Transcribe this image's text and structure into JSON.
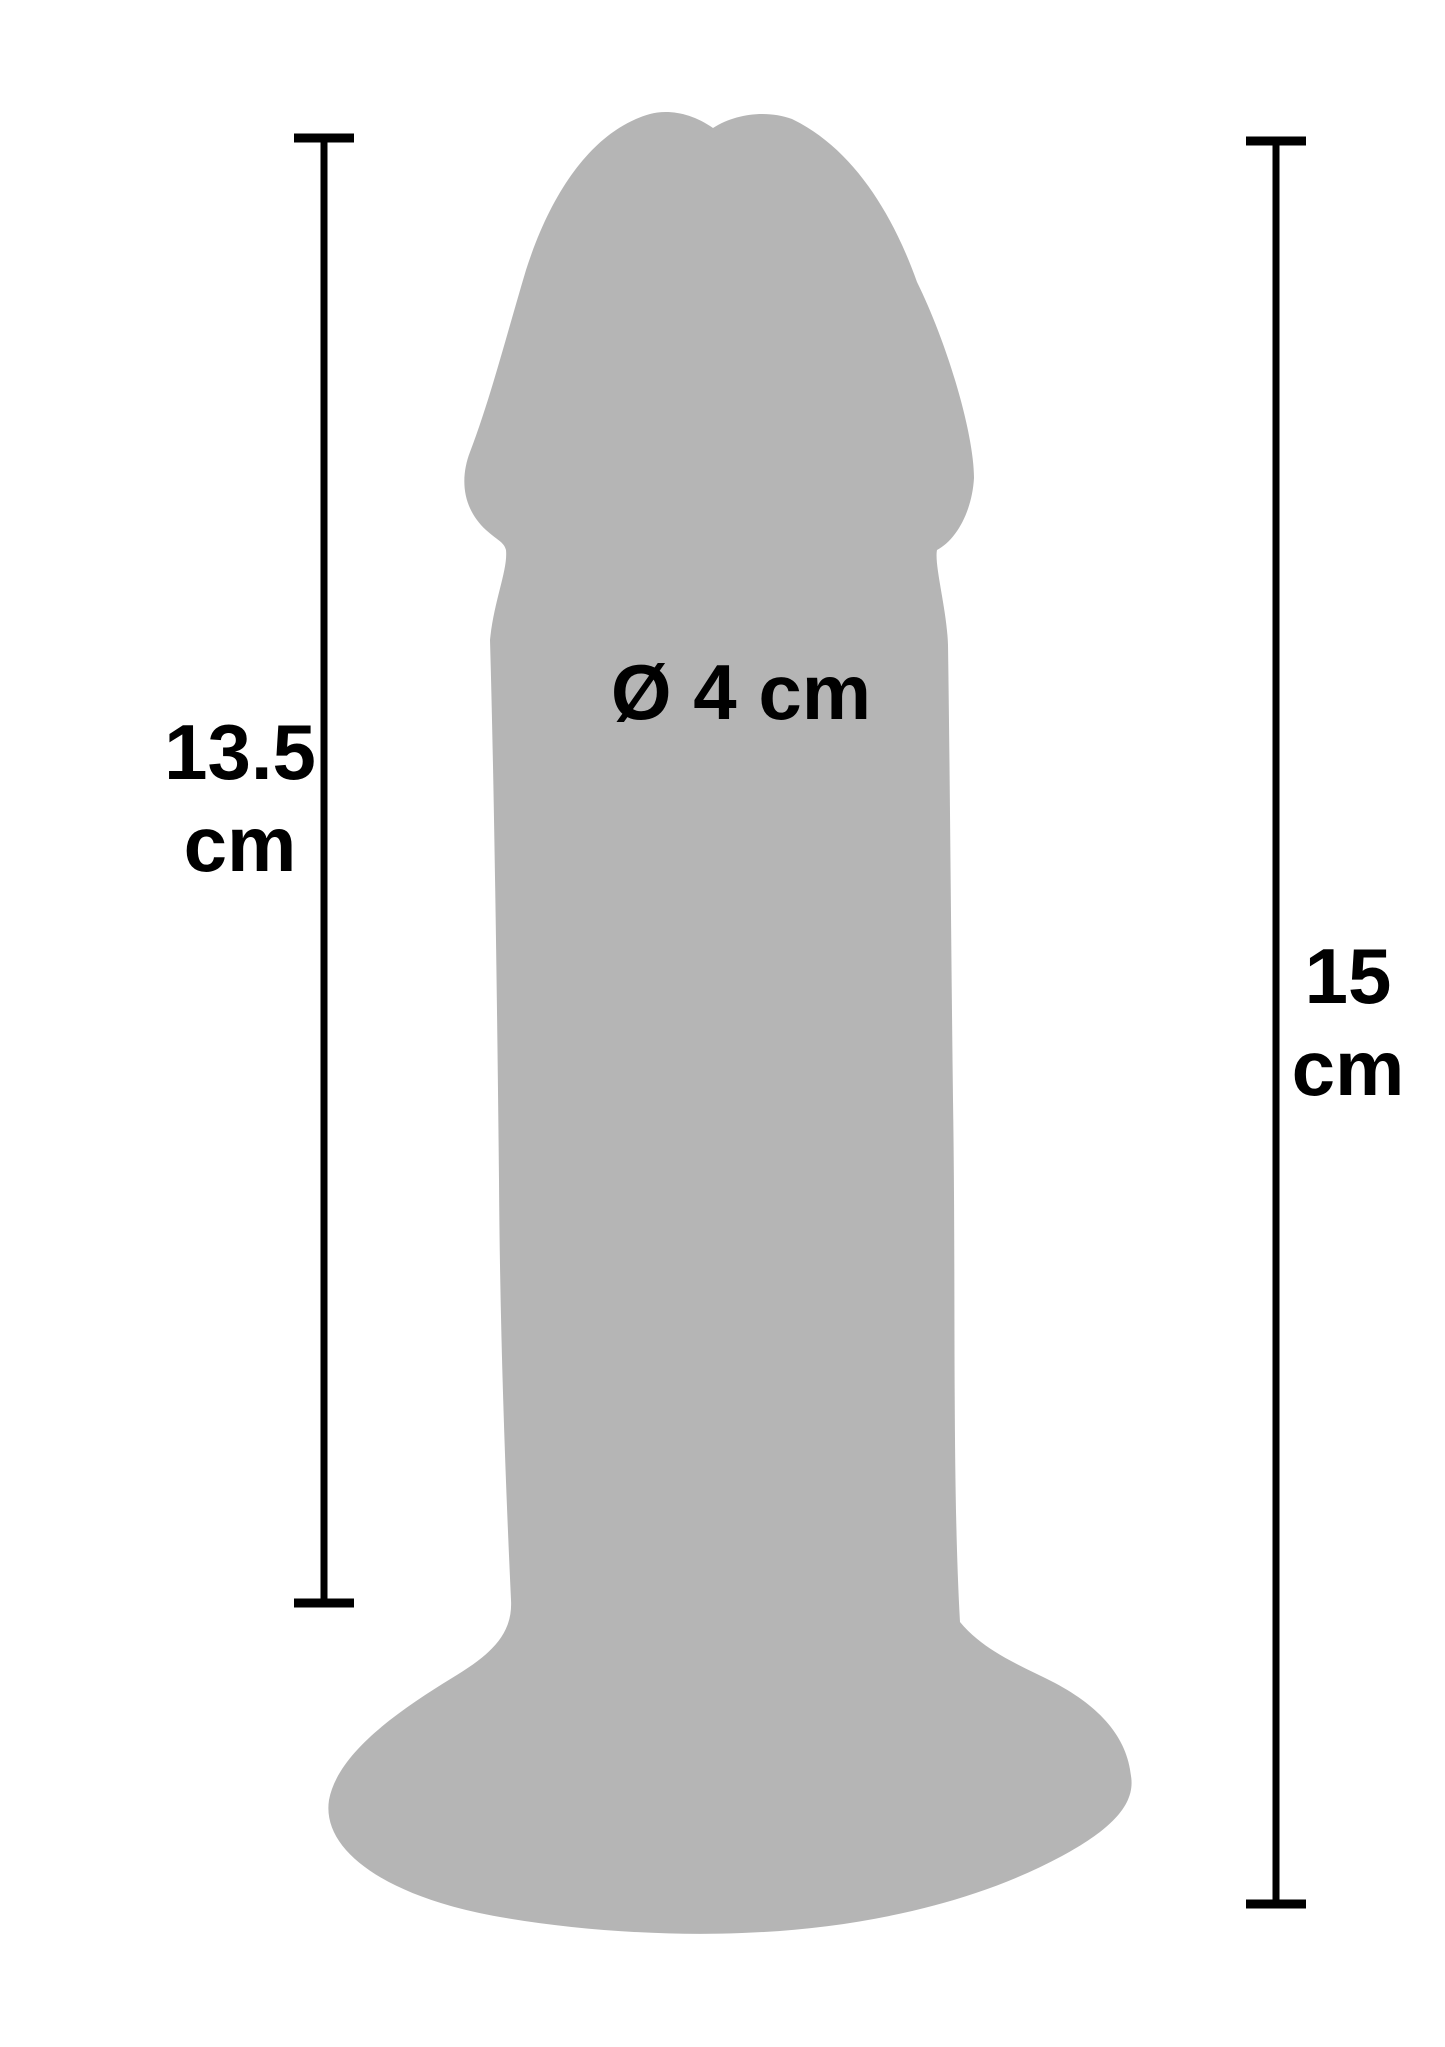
{
  "diagram": {
    "type": "product-dimension-diagram",
    "labels": {
      "left_measurement": {
        "value": "13.5",
        "unit": "cm"
      },
      "diameter": {
        "text": "Ø 4 cm"
      },
      "right_measurement": {
        "value": "15",
        "unit": "cm"
      }
    },
    "colors": {
      "background": "#ffffff",
      "silhouette": "#b5b5b5",
      "line": "#000000",
      "text": "#000000"
    }
  }
}
